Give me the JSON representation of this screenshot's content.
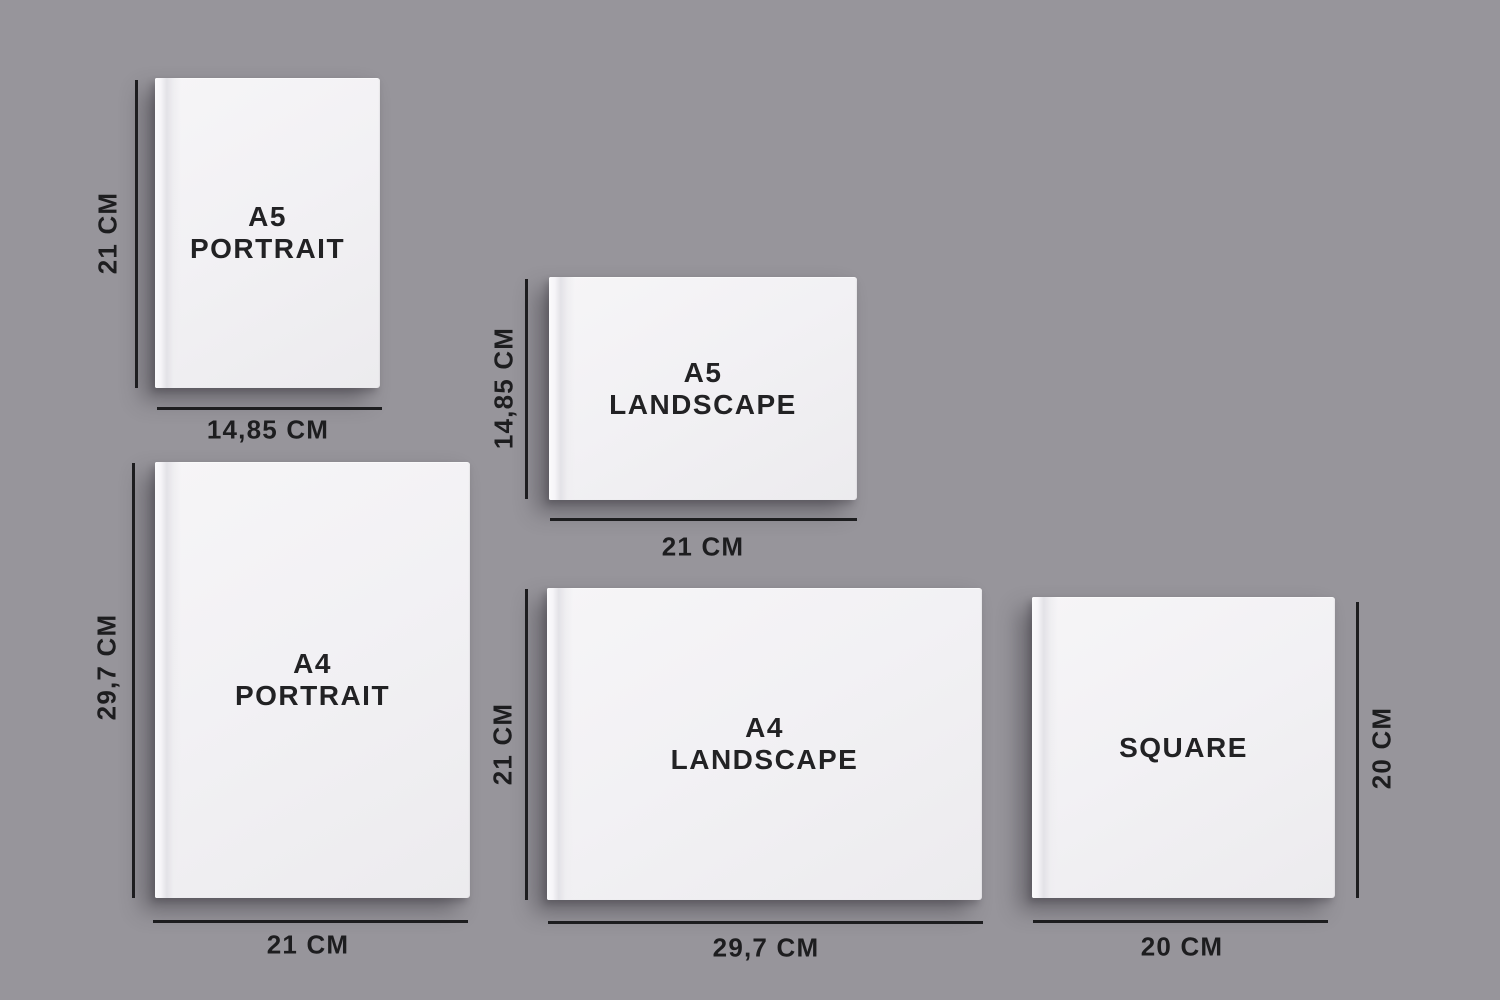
{
  "canvas": {
    "background_color": "#97959b",
    "ink_color": "#1d1d1f",
    "cover_color": "#f1f0f3"
  },
  "books": {
    "a5_portrait": {
      "title_lines": [
        "A5",
        "PORTRAIT"
      ],
      "height_label": "21 CM",
      "width_label": "14,85 CM"
    },
    "a5_landscape": {
      "title_lines": [
        "A5",
        "LANDSCAPE"
      ],
      "height_label": "14,85 CM",
      "width_label": "21 CM"
    },
    "a4_portrait": {
      "title_lines": [
        "A4",
        "PORTRAIT"
      ],
      "height_label": "29,7 CM",
      "width_label": "21 CM"
    },
    "a4_landscape": {
      "title_lines": [
        "A4",
        "LANDSCAPE"
      ],
      "height_label": "21 CM",
      "width_label": "29,7 CM"
    },
    "square": {
      "title_lines": [
        "SQUARE"
      ],
      "height_label": "20 CM",
      "width_label": "20 CM"
    }
  }
}
